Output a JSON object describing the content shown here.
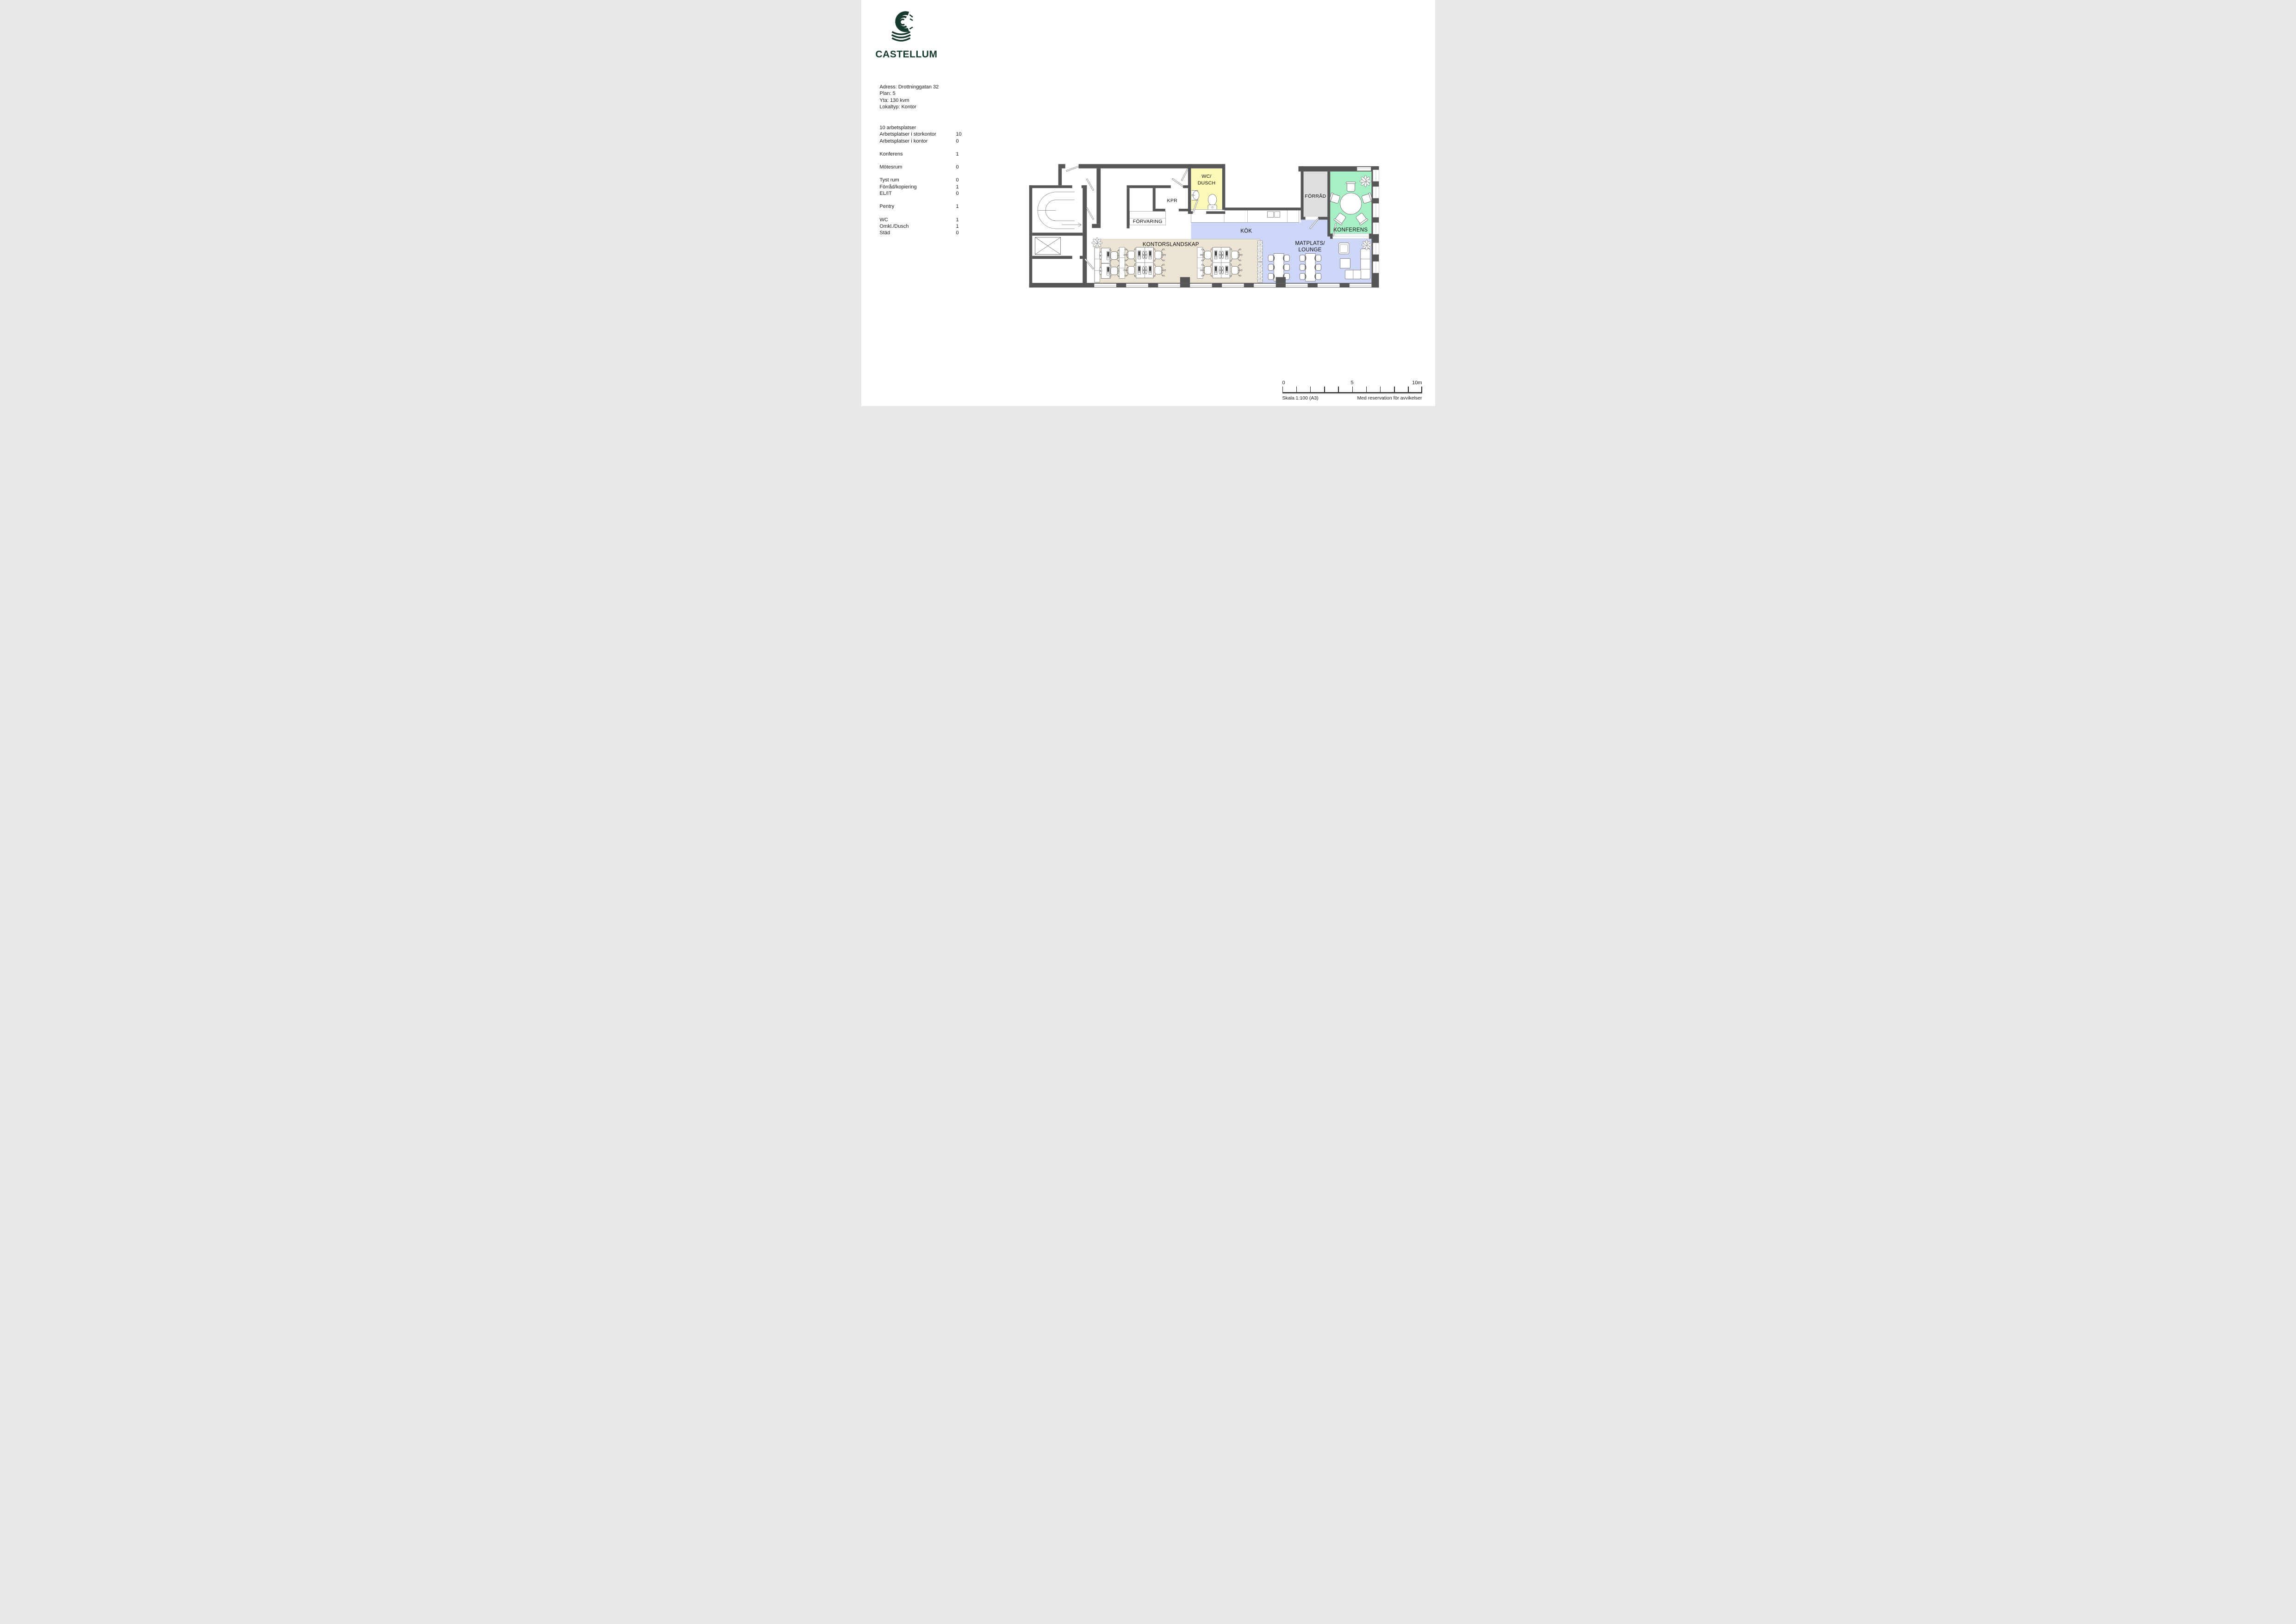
{
  "brand": {
    "name": "CASTELLUM",
    "color": "#16382f"
  },
  "address": {
    "line1": "Adress: Drottninggatan 32",
    "line2": "Plan: 5",
    "line3": "Yta: 130 kvm",
    "line4": "Lokaltyp: Kontor"
  },
  "stats": {
    "title": "10 arbetsplatser",
    "groups": [
      [
        {
          "label": "Arbetsplatser i storkontor",
          "value": "10"
        },
        {
          "label": "Arbetsplatser i kontor",
          "value": "0"
        }
      ],
      [
        {
          "label": "Konferens",
          "value": "1"
        }
      ],
      [
        {
          "label": "Mötesrum",
          "value": "0"
        }
      ],
      [
        {
          "label": "Tyst rum",
          "value": "0"
        },
        {
          "label": "Förråd/kopiering",
          "value": "1"
        },
        {
          "label": "EL/IT",
          "value": "0"
        }
      ],
      [
        {
          "label": "Pentry",
          "value": "1"
        }
      ],
      [
        {
          "label": "WC",
          "value": "1"
        },
        {
          "label": "Omkl./Dusch",
          "value": "1"
        },
        {
          "label": "Städ",
          "value": "0"
        }
      ]
    ]
  },
  "plan": {
    "rooms": {
      "kpr": "KPR",
      "wc_line1": "WC/",
      "wc_line2": "DUSCH",
      "forvaring": "FÖRVARING",
      "kok": "KÖK",
      "kontorslandskap": "KONTORSLANDSKAP",
      "matplats_line1": "MATPLATS/",
      "matplats_line2": "LOUNGE",
      "forrad": "FÖRRÅD",
      "konferens": "KONFERENS"
    },
    "colors": {
      "wall": "#565658",
      "wet": "#fcf9b8",
      "social": "#cdd6f7",
      "storage": "#dedede",
      "conference": "#a7f0c5",
      "office": "#ece4d2"
    }
  },
  "scalebar": {
    "start": "0",
    "mid": "5",
    "end": "10m",
    "scale_text": "Skala 1:100 (A3)",
    "disclaimer": "Med reservation för avvikelser"
  }
}
